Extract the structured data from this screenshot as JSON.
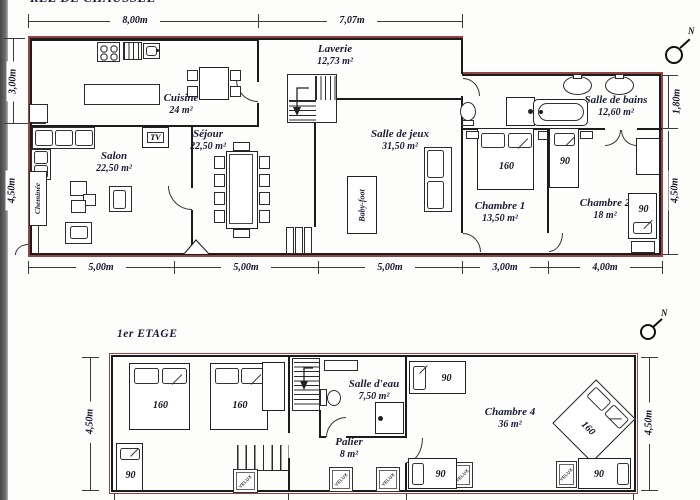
{
  "ground_floor": {
    "title": "REZ DE CHAUSSEE",
    "compass": "N",
    "rooms": {
      "cuisine": {
        "name": "Cuisine",
        "area": "24 m²"
      },
      "laverie": {
        "name": "Laverie",
        "area": "12,73 m²"
      },
      "salon": {
        "name": "Salon",
        "area": "22,50 m²"
      },
      "sejour": {
        "name": "Séjour",
        "area": "22,50 m²"
      },
      "salle_de_jeux": {
        "name": "Salle de jeux",
        "area": "31,50 m²"
      },
      "salle_de_bains": {
        "name": "Salle de bains",
        "area": "12,60 m²"
      },
      "chambre1": {
        "name": "Chambre 1",
        "area": "13,50 m²"
      },
      "chambre2": {
        "name": "Chambre 2",
        "area": "18 m²"
      }
    },
    "features": {
      "cheminee": "Cheminée",
      "tv": "TV",
      "babyfoot": "Baby-foot"
    },
    "beds": {
      "chambre1": "160",
      "chambre2_a": "90",
      "chambre2_b": "90"
    },
    "dimensions": {
      "top": [
        "8,00m",
        "7,07m"
      ],
      "left": [
        "3,00m",
        "4,50m"
      ],
      "right": [
        "1,80m",
        "4,50m"
      ],
      "bottom": [
        "5,00m",
        "5,00m",
        "5,00m",
        "3,00m",
        "4,00m"
      ]
    }
  },
  "first_floor": {
    "title": "1er ETAGE",
    "compass": "N",
    "rooms": {
      "salle_deau": {
        "name": "Salle d'eau",
        "area": "7,50 m²"
      },
      "palier": {
        "name": "Palier",
        "area": "8 m²"
      },
      "chambre4": {
        "name": "Chambre 4",
        "area": "36 m²"
      }
    },
    "beds": {
      "left_a": "160",
      "left_b": "160",
      "left_c": "90",
      "ch4_top": "90",
      "ch4_diag": "160",
      "ch4_bottom_a": "90",
      "ch4_bottom_b": "90"
    },
    "velux_label": "VELUX",
    "dimensions": {
      "left": "4,50m",
      "right": "4,50m"
    }
  }
}
